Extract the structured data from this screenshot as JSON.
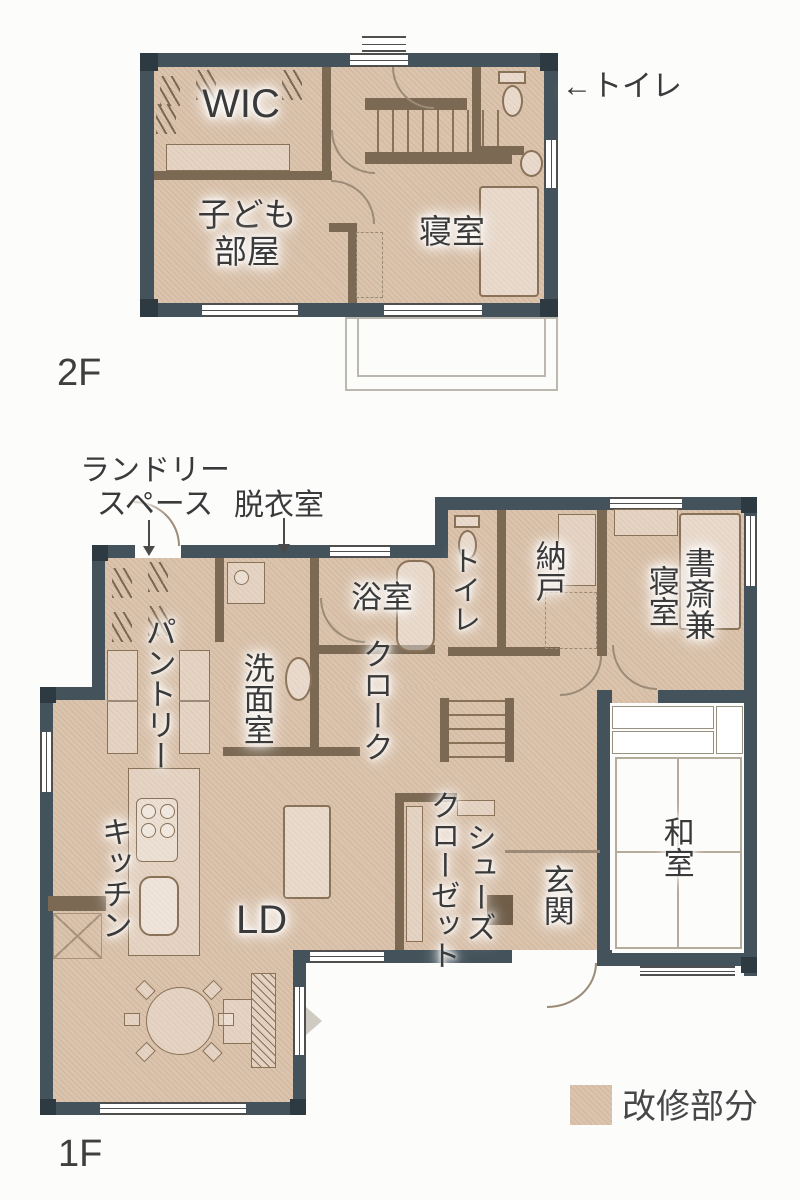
{
  "colors": {
    "outer_wall": "#44525b",
    "interior_wall": "#7b6954",
    "renovation_fill": "#d9c2ac",
    "label_text": "#3a3a3a"
  },
  "floor_2f": {
    "floor_label": "2F",
    "room_labels": {
      "wic": "WIC",
      "kids_room_line1": "子ども",
      "kids_room_line2": "部屋",
      "bedroom": "寝室"
    },
    "annotations": {
      "toilet": "←トイレ"
    }
  },
  "floor_1f": {
    "floor_label": "1F",
    "annotations": {
      "laundry_line1": "ランドリー",
      "laundry_line2": "スペース",
      "dressing_room": "脱衣室"
    },
    "room_labels": {
      "bathroom": "浴室",
      "toilet": "トイレ",
      "storage": "納戸",
      "study_bedroom_col1": "書斎兼",
      "study_bedroom_col2": "寝室",
      "washroom": "洗面室",
      "pantry": "パントリー",
      "cloak": "クローク",
      "kitchen": "キッチン",
      "living_dining": "LD",
      "shoes_closet_col1": "シューズ",
      "shoes_closet_col2": "クローゼット",
      "entrance": "玄関",
      "japanese_room": "和室"
    }
  },
  "legend": {
    "label": "改修部分",
    "swatch_color": "#d9c2ac"
  }
}
